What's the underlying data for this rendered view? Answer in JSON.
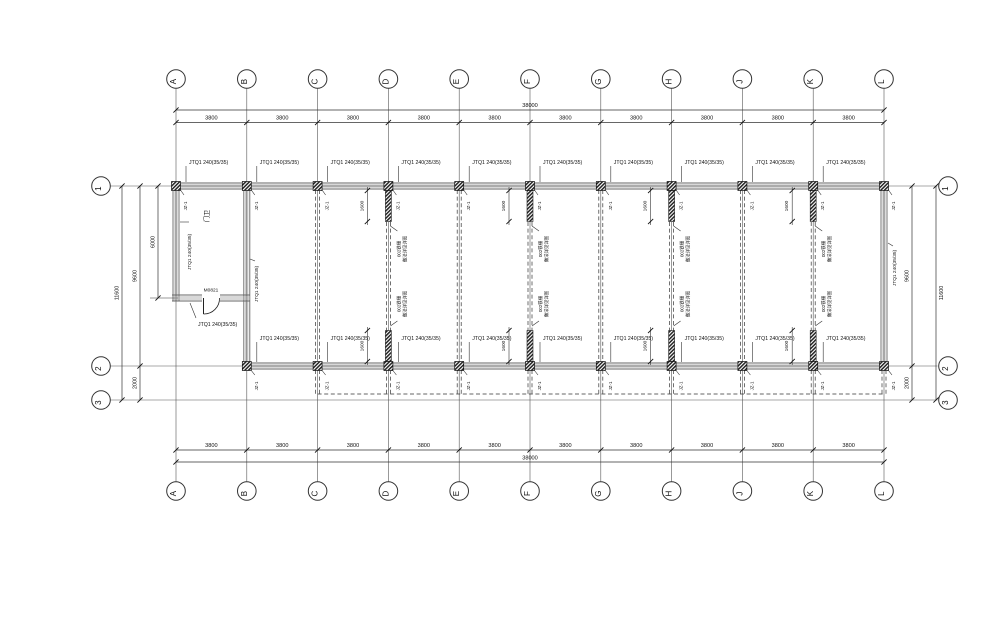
{
  "drawing": {
    "grid": {
      "columns": [
        "A",
        "B",
        "C",
        "D",
        "E",
        "F",
        "G",
        "H",
        "J",
        "K",
        "L"
      ],
      "rows": [
        "1",
        "2",
        "3"
      ]
    },
    "dimensions": {
      "bay": "3800",
      "total_width": "38000",
      "row1_to_row2": "9600",
      "row2_to_row3": "2000",
      "total_height": "11600",
      "room_depth": "6000",
      "grille_length": "1600"
    },
    "annotations": {
      "wall_tag": "JTQ1 240(35/35)",
      "column_tag": "JZ-1",
      "door_tag": "M0821",
      "room_name": "门卫",
      "grille_note_line1": "002铁栅",
      "grille_note_line2": "做法详见详图"
    },
    "partitions": {
      "grille_columns": [
        "D",
        "F",
        "H",
        "K"
      ],
      "dashed_columns": [
        "C",
        "D",
        "E",
        "F",
        "G",
        "H",
        "J",
        "K"
      ]
    },
    "colors": {
      "line": "#444",
      "wall_edge": "#666",
      "wall_inner": "#b0b0b0",
      "text": "#111",
      "background": "#ffffff"
    }
  }
}
